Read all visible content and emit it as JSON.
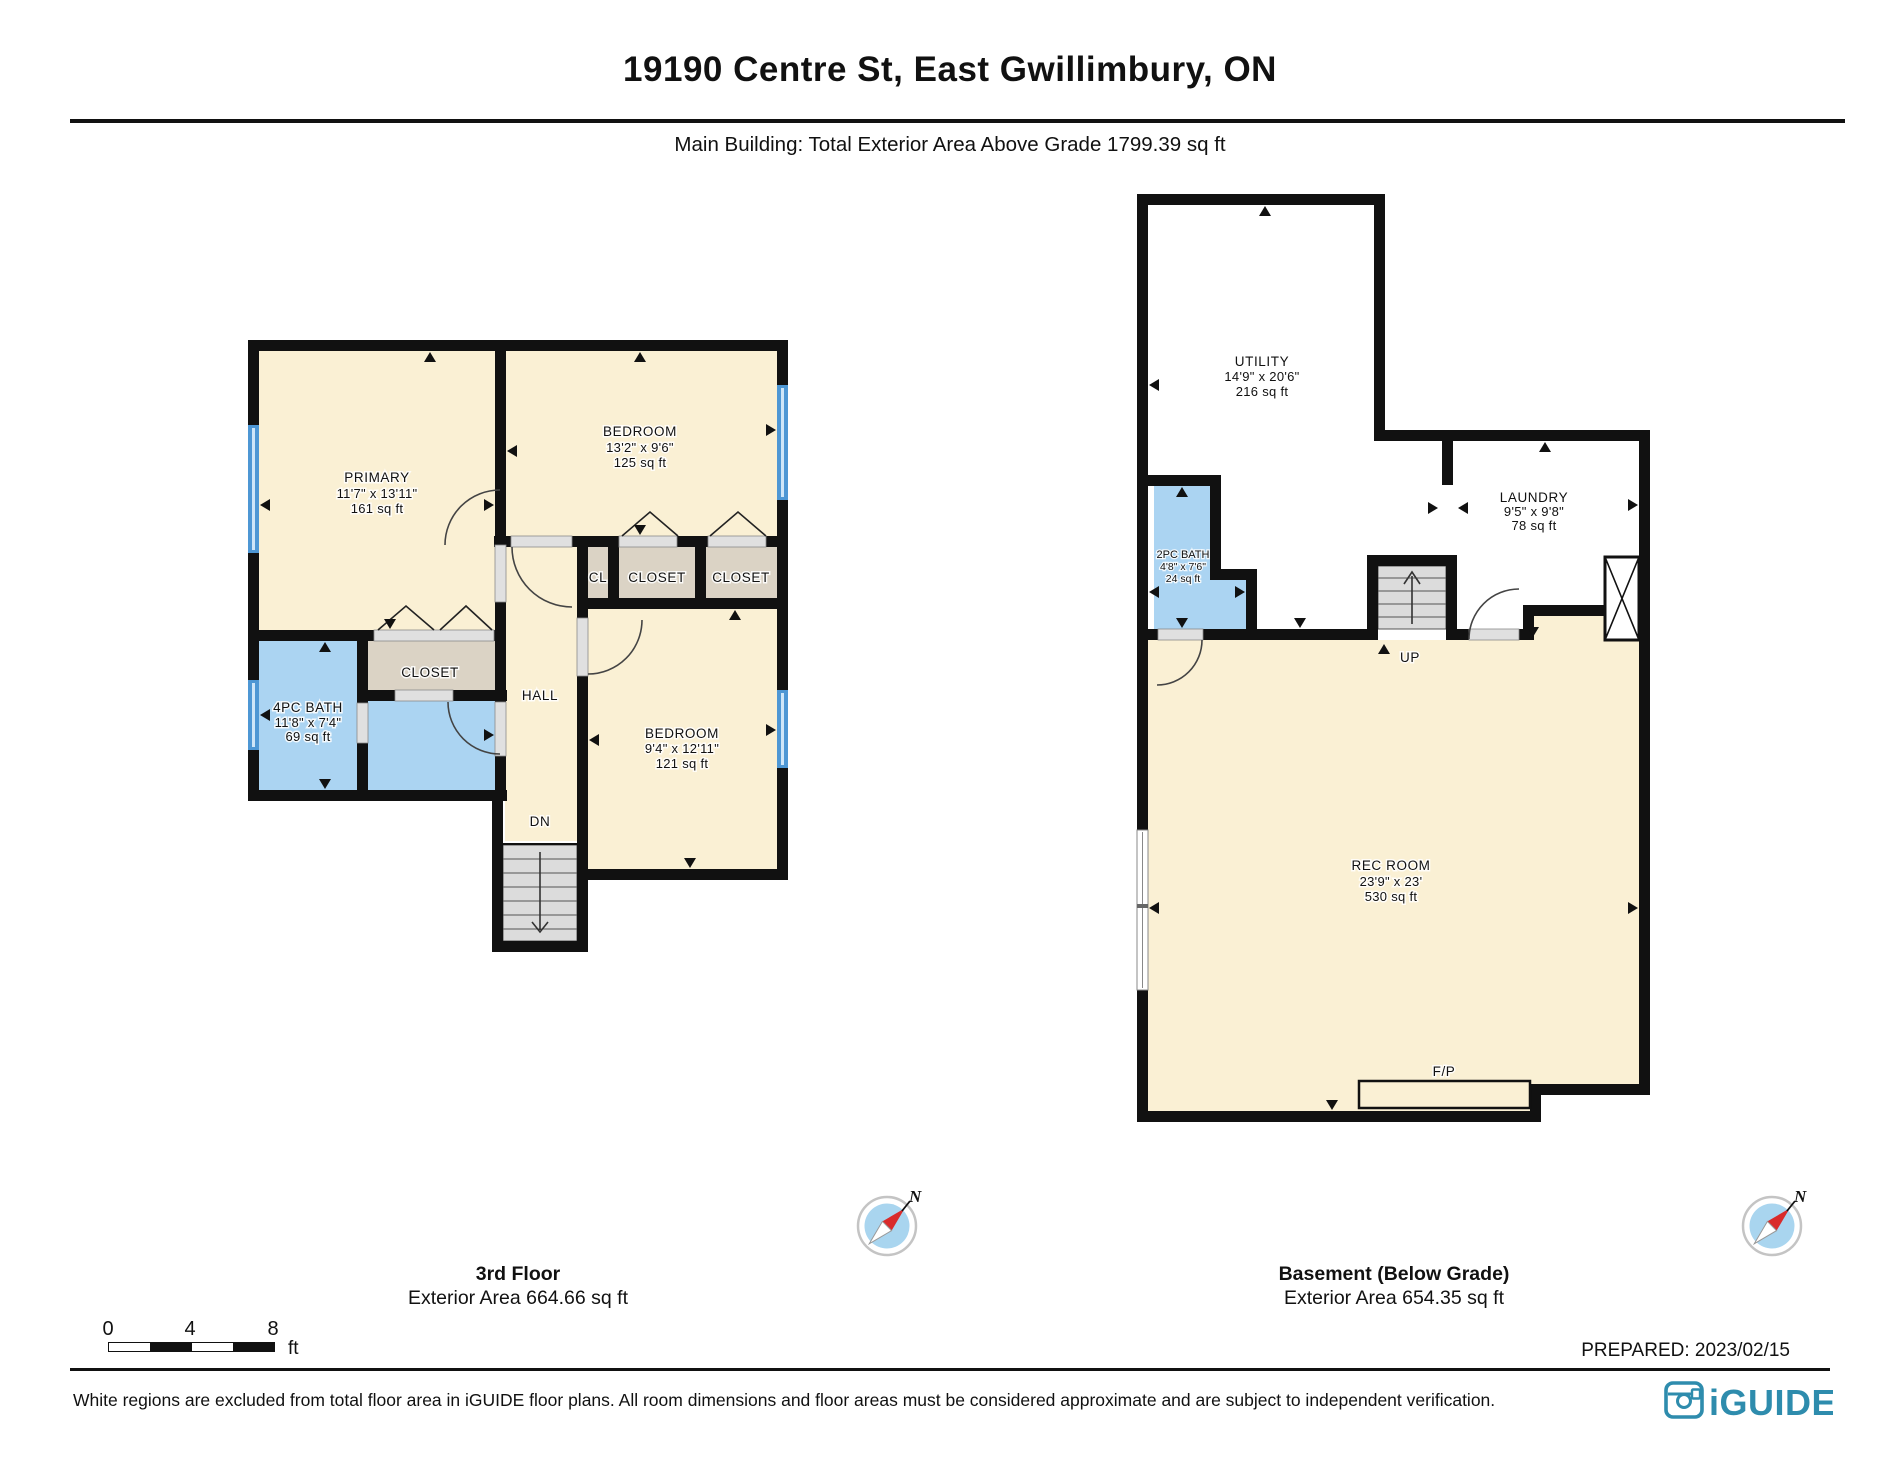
{
  "header": {
    "title": "19190 Centre St, East Gwillimbury, ON",
    "subtitle": "Main Building: Total Exterior Area Above Grade 1799.39 sq ft"
  },
  "floor_left": {
    "label": "3rd Floor",
    "area_label": "Exterior Area 664.66 sq ft",
    "rooms": {
      "primary": {
        "name": "PRIMARY",
        "dims": "11'7\" x 13'11\"",
        "area": "161 sq ft"
      },
      "bedroom1": {
        "name": "BEDROOM",
        "dims": "13'2\" x 9'6\"",
        "area": "125 sq ft"
      },
      "bedroom2": {
        "name": "BEDROOM",
        "dims": "9'4\" x 12'11\"",
        "area": "121 sq ft"
      },
      "bath": {
        "name": "4PC BATH",
        "dims": "11'8\" x 7'4\"",
        "area": "69 sq ft"
      },
      "closet_primary": {
        "name": "CLOSET"
      },
      "cl": {
        "name": "CL"
      },
      "closet_mid": {
        "name": "CLOSET"
      },
      "closet_right": {
        "name": "CLOSET"
      },
      "hall": {
        "name": "HALL"
      },
      "stairs": {
        "label": "DN"
      }
    }
  },
  "floor_right": {
    "label": "Basement (Below Grade)",
    "area_label": "Exterior Area 654.35 sq ft",
    "rooms": {
      "utility": {
        "name": "UTILITY",
        "dims": "14'9\" x 20'6\"",
        "area": "216 sq ft"
      },
      "laundry": {
        "name": "LAUNDRY",
        "dims": "9'5\" x 9'8\"",
        "area": "78 sq ft"
      },
      "bath": {
        "name": "2PC BATH",
        "dims": "4'8\" x 7'6\"",
        "area": "24 sq ft"
      },
      "rec_room": {
        "name": "REC ROOM",
        "dims": "23'9\" x 23'",
        "area": "530 sq ft"
      },
      "stairs": {
        "label": "UP"
      },
      "fireplace": {
        "label": "F/P"
      }
    }
  },
  "compass": {
    "label": "N"
  },
  "scale_bar": {
    "tick0": "0",
    "tick1": "4",
    "tick2": "8",
    "unit": "ft"
  },
  "prepared_label": "PREPARED: 2023/02/15",
  "disclaimer": "White regions are excluded from total floor area in iGUIDE floor plans. All room dimensions and floor areas must be considered approximate and are subject to independent verification.",
  "logo": {
    "text": "iGUIDE"
  },
  "colors": {
    "room_fill": "#FAF0D4",
    "bath_fill": "#ABD4F2",
    "closet_fill": "#DBD3C5",
    "wall": "#111111",
    "window": "#4E97D4",
    "stairs_fill": "#DCDCDC",
    "leaf": "#E0E0E0",
    "arrow": "#111111",
    "compass_fill": "#A9D5EF",
    "logo": "#2E8CAD"
  }
}
